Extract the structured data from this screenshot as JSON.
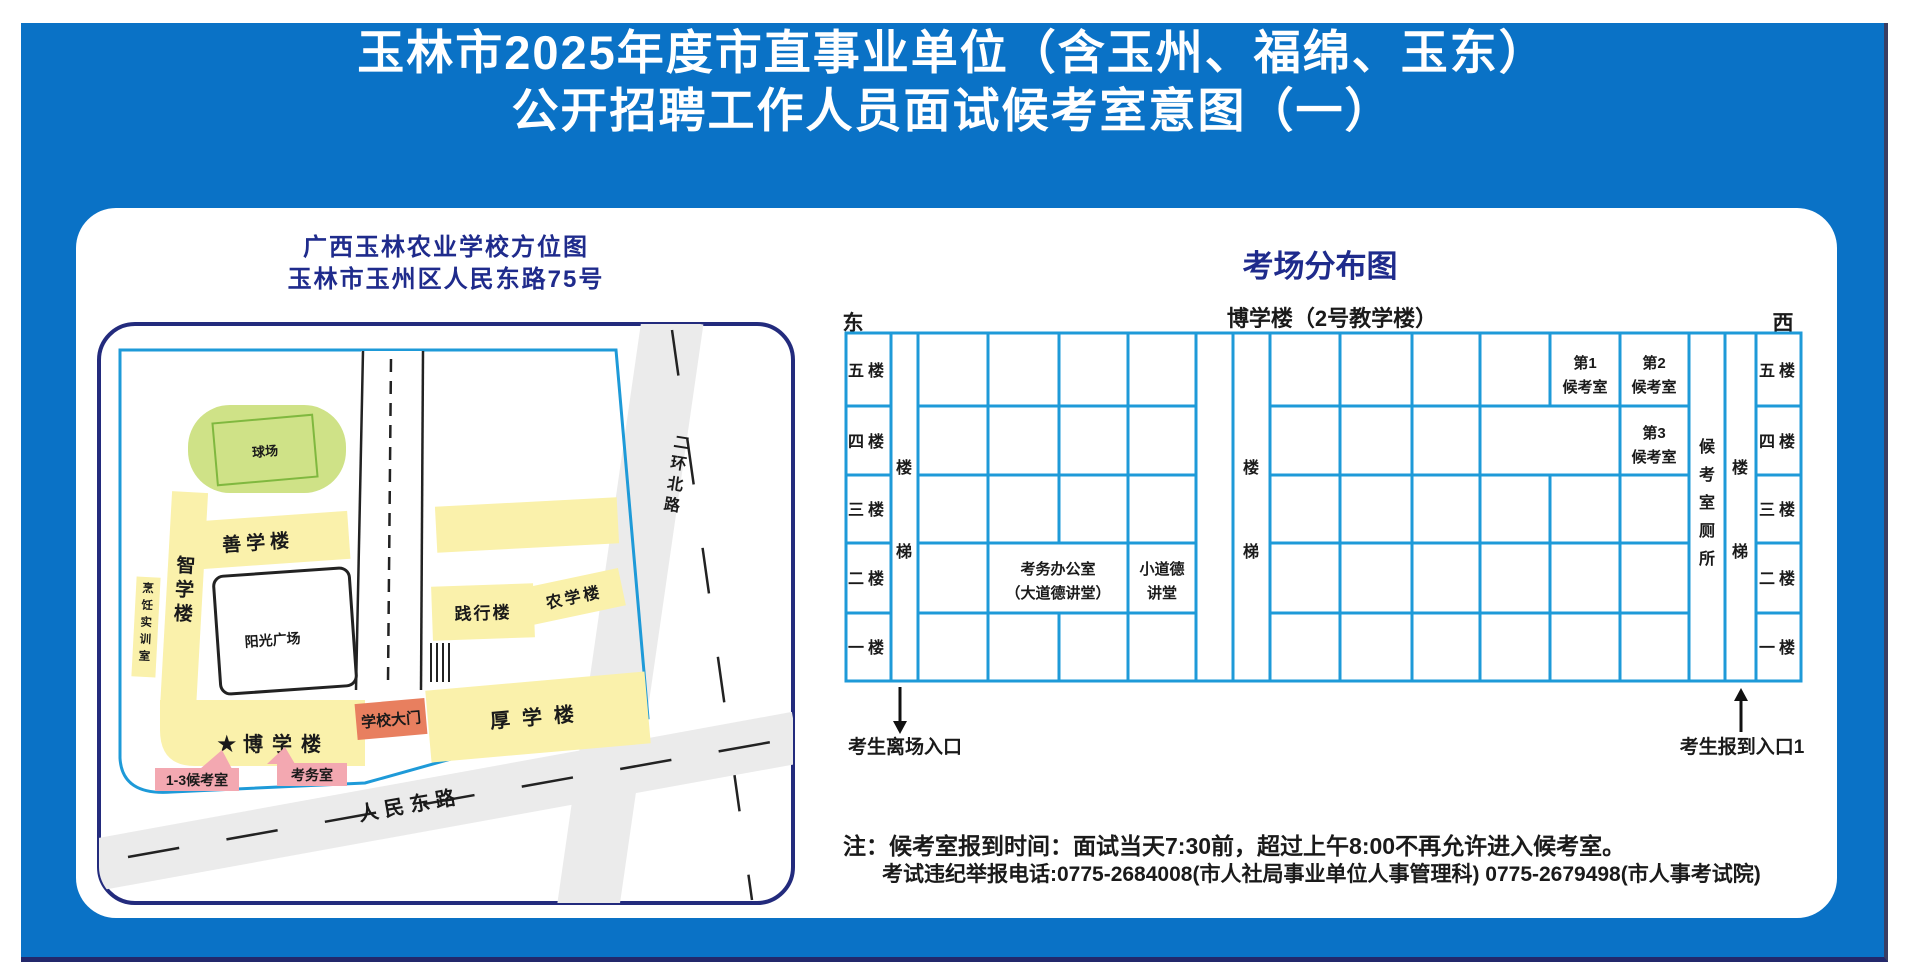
{
  "colors": {
    "banner_blue": "#0a72c6",
    "navy": "#232b7d",
    "grid_blue": "#1e9ad8",
    "building_yellow": "#faf1ab",
    "field_green": "#cfe287",
    "field_green_border": "#80b83f",
    "gate_salmon": "#e87f5f",
    "label_pink": "#f3a8b1",
    "road_gray": "#ebebeb",
    "star_red": "#e60013"
  },
  "header": {
    "title_line1": "玉林市2025年度市直事业单位（含玉州、福绵、玉东）",
    "title_line2": "公开招聘工作人员面试候考室意图（一）"
  },
  "campus_map": {
    "title_line1": "广西玉林农业学校方位图",
    "title_line2": "玉林市玉州区人民东路75号",
    "ball_field": "球场",
    "shanxue": "善学楼",
    "zhixue": "智学楼",
    "cooking": "烹饪实训室",
    "plaza": "阳光广场",
    "jianxing": "践行楼",
    "nongxue": "农学楼",
    "houxue": "厚学楼",
    "boxue": "博学楼",
    "star": "★",
    "gate": "学校大门",
    "waiting_label": "1-3候考室",
    "office_label": "考务室",
    "road_north": "二环北路",
    "road_east": "人民东路"
  },
  "floor_plan": {
    "title": "考场分布图",
    "building": "博学楼（2号教学楼）",
    "east": "东",
    "west": "西",
    "floors": [
      "五楼",
      "四楼",
      "三楼",
      "二楼",
      "一楼"
    ],
    "stair_top": "楼",
    "stair_bottom": "梯",
    "waiting1_l1": "第1",
    "waiting1_l2": "候考室",
    "waiting2_l1": "第2",
    "waiting2_l2": "候考室",
    "waiting3_l1": "第3",
    "waiting3_l2": "候考室",
    "office_l1": "考务办公室",
    "office_l2": "（大道德讲堂）",
    "lecture_l1": "小道德",
    "lecture_l2": "讲堂",
    "toilet": "候考室厕所",
    "exit_label": "考生离场入口",
    "entry_label": "考生报到入口1"
  },
  "notes": {
    "line1": "注：候考室报到时间：面试当天7:30前，超过上午8:00不再允许进入候考室。",
    "line2": "考试违纪举报电话:0775-2684008(市人社局事业单位人事管理科)  0775-2679498(市人事考试院)"
  }
}
